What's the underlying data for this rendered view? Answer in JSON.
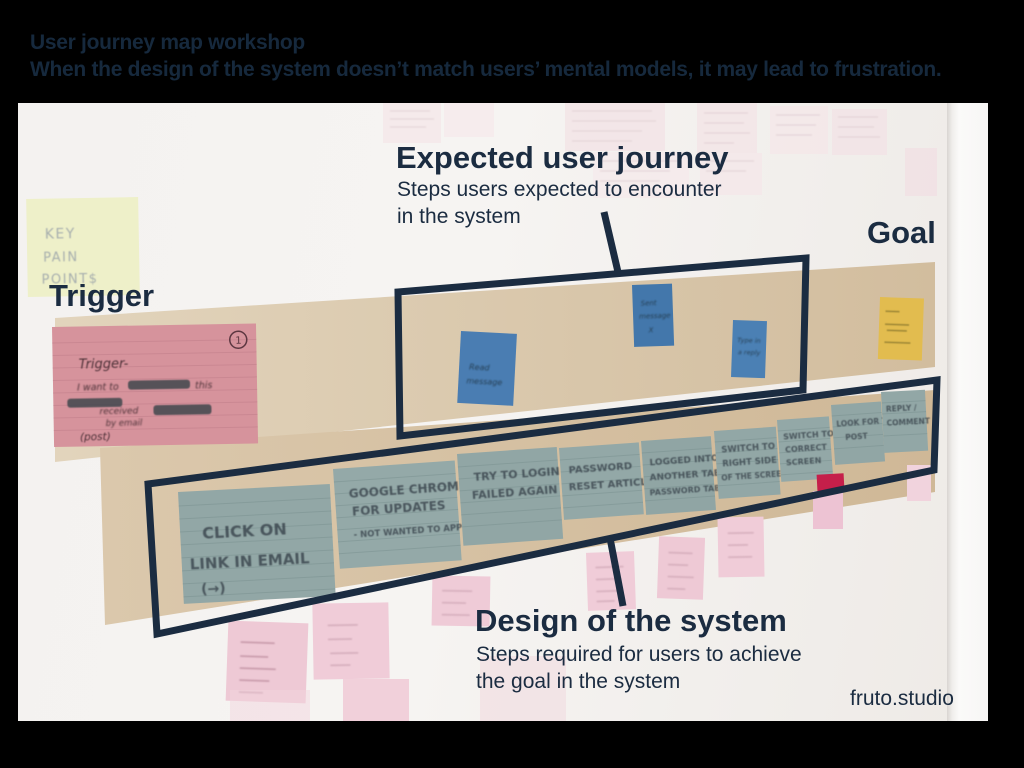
{
  "slide": {
    "title": "User journey map workshop",
    "subtitle": "When the design of the system doesn’t match users’ mental models, it may lead to frustration.",
    "credit": "fruto.studio"
  },
  "callouts": {
    "expected": {
      "title": "Expected user journey",
      "desc1": "Steps users expected to encounter",
      "desc2": "in the system"
    },
    "design": {
      "title": "Design of the system",
      "desc1": "Steps required for users to achieve",
      "desc2": "the goal in the system"
    },
    "trigger": "Trigger",
    "goal": "Goal"
  },
  "board": {
    "pain_note": {
      "l1": "KEY",
      "l2": "PAIN",
      "l3": "POINT$"
    },
    "trigger_card": {
      "number": "1",
      "title": "Trigger-",
      "b1": "I want to",
      "b2": "this",
      "b3": "received",
      "b4": "by email",
      "footer": "(post)"
    },
    "expected_notes": [
      {
        "l1": "Read",
        "l2": "message"
      },
      {
        "l1": "Sent",
        "l2": "message",
        "l3": "X"
      },
      {
        "l1": "Type in",
        "l2": "a reply"
      }
    ],
    "design_cards": [
      {
        "l1": "CLICK ON",
        "l2": "LINK IN EMAIL",
        "l3": "(→)"
      },
      {
        "l1": "GOOGLE CHROME",
        "l2": "FOR UPDATES",
        "l3": "- NOT WANTED TO APP"
      },
      {
        "l1": "TRY TO LOGIN",
        "l2": "FAILED AGAIN"
      },
      {
        "l1": "PASSWORD",
        "l2": "RESET ARTICLE"
      },
      {
        "l1": "LOGGED INTO",
        "l2": "ANOTHER TAB",
        "l3": "PASSWORD TAB"
      },
      {
        "l1": "SWITCH TO",
        "l2": "RIGHT SIDE",
        "l3": "OF THE SCREEN"
      },
      {
        "l1": "SWITCH TO",
        "l2": "CORRECT",
        "l3": "SCREEN"
      },
      {
        "l1": "LOOK FOR THE",
        "l2": "POST"
      },
      {
        "l1": "REPLY /",
        "l2": "COMMENT"
      }
    ]
  },
  "colors": {
    "annotation_navy": "#1b2c41",
    "header_navy": "#16293d",
    "kraft": "#d8c5a9",
    "card_blue_gray": "#92a7a6",
    "note_blue": "#4a7db2"
  }
}
